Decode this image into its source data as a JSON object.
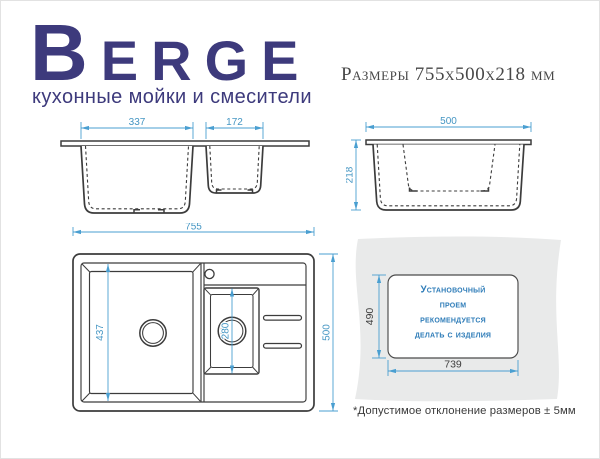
{
  "header": {
    "brand": "Berge",
    "tagline": "кухонные мойки и смесители",
    "size_label": "Размеры 755х500х218 мм"
  },
  "views": {
    "front": {
      "main_bowl_width": "337",
      "second_bowl_width": "172"
    },
    "side": {
      "overall_width": "500",
      "overall_height": "218"
    },
    "top": {
      "overall_length": "755",
      "overall_width": "500",
      "main_bowl_length": "437",
      "second_bowl_length": "280"
    },
    "cutout": {
      "opening_height": "490",
      "opening_width": "739",
      "note_lines": [
        "Установочный",
        "проем",
        "рекомендуется",
        "делать с изделия"
      ]
    }
  },
  "footnote": "*Допустимое отклонение размеров ± 5мм",
  "colors": {
    "brand_navy": "#3d3a7c",
    "dimension_blue": "#4a9fd1",
    "dimension_text_blue": "#4596c3",
    "drawing_stroke": "#3c3c3c",
    "panel_gray": "#e9eaea",
    "cutout_note_blue": "#2e7cb8",
    "dark_text": "#3e3e3e"
  }
}
